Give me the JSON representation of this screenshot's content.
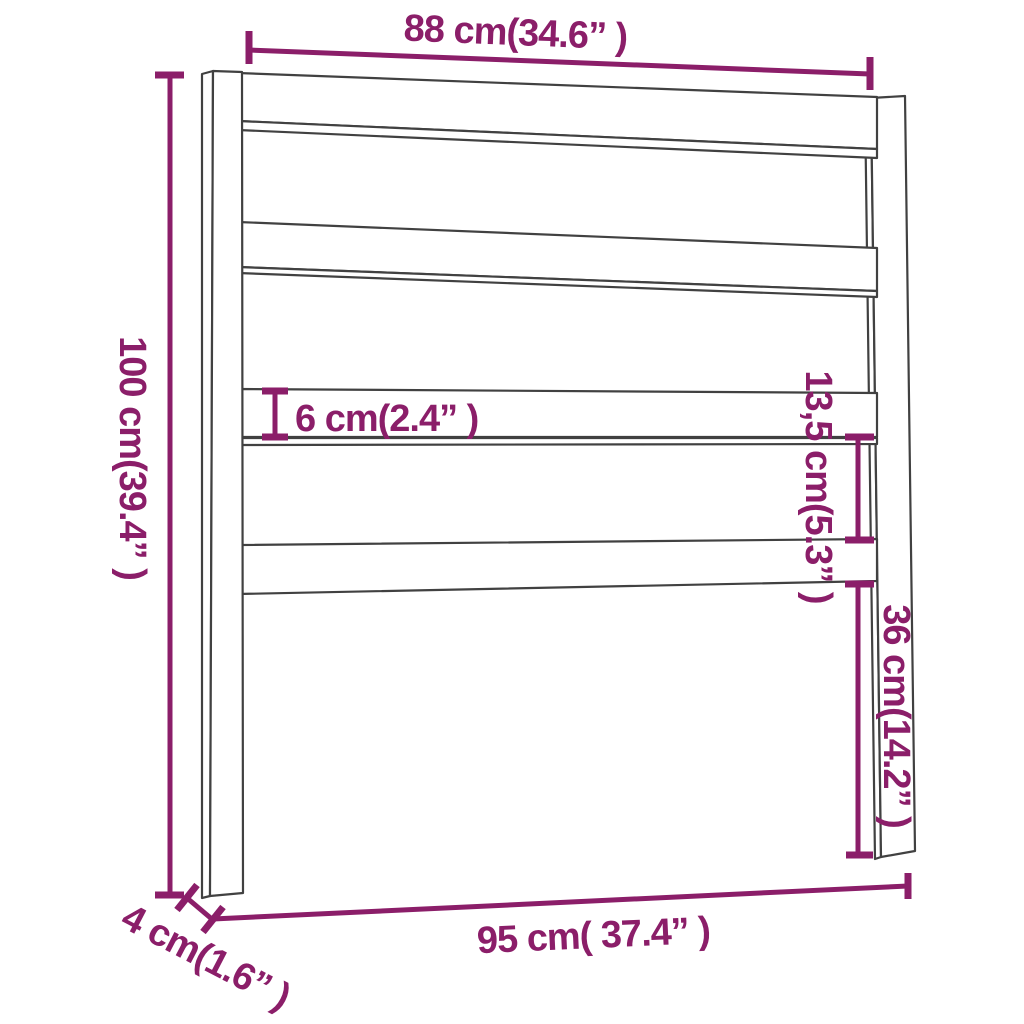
{
  "diagram": {
    "description": "Bed headboard dimension drawing: two vertical posts with a top rail and three horizontal slats, annotated with purple measurement lines"
  },
  "colors": {
    "annotation": "#8B1E69",
    "outline": "#414141",
    "background": "#FFFFFF"
  },
  "dimensions": {
    "overall_width_top": {
      "label": "88 cm(34.6” )",
      "cm": 88,
      "inches": 34.6
    },
    "overall_height": {
      "label": "100 cm(39.4” )",
      "cm": 100,
      "inches": 39.4
    },
    "slat_height": {
      "label": "6 cm(2.4” )",
      "cm": 6,
      "inches": 2.4
    },
    "slat_gap": {
      "label": "13,5 cm(5.3” )",
      "cm": 13.5,
      "inches": 5.3
    },
    "lower_section_height": {
      "label": "36 cm(14.2” )",
      "cm": 36,
      "inches": 14.2
    },
    "overall_width_bottom": {
      "label": "95 cm( 37.4” )",
      "cm": 95,
      "inches": 37.4
    },
    "post_depth": {
      "label": "4 cm(1.6” )",
      "cm": 4,
      "inches": 1.6
    }
  }
}
